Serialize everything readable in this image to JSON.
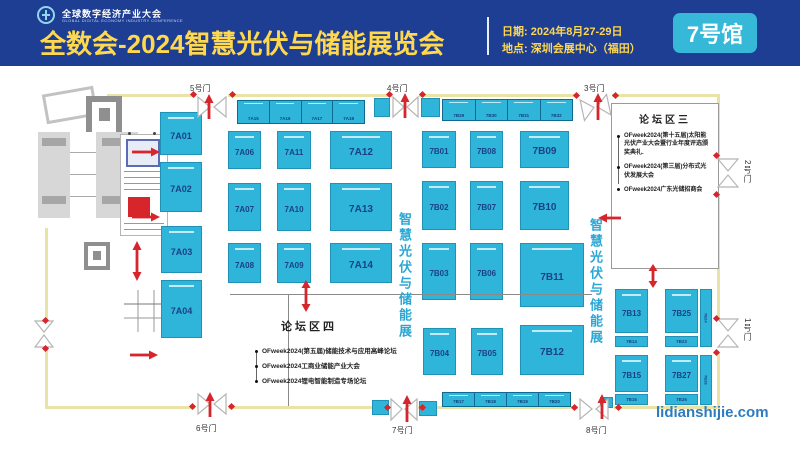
{
  "header": {
    "logo_title": "全球数字经济产业大会",
    "logo_subtitle": "GLOBAL DIGITAL ECONOMY INDUSTRY CONFERENCE",
    "title": "全数会-2024智慧光伏与储能展览会",
    "date": "日期: 2024年8月27-29日",
    "venue": "地点: 深圳会展中心（福田）",
    "hall": "7号馆"
  },
  "banner_vertical": "智慧光伏与储能展",
  "watermark": "lidianshijie.com",
  "doors": [
    "1号门",
    "2号门",
    "3号门",
    "4号门",
    "5号门",
    "6号门",
    "7号门",
    "8号门"
  ],
  "forum3": {
    "title": "论坛区三",
    "items": [
      "OFweek2024(第十五届)太阳能光伏产业大会暨行业年度评选颁奖典礼.",
      "OFweek2024(第三届)分布式光伏发展大会",
      "OFweek2024广东光储招商会"
    ]
  },
  "forum4": {
    "title": "论坛区四",
    "items": [
      "OFweek2024(第五届)储能技术与应用高峰论坛",
      "OFweek2024工商业储能产业大会",
      "OFweek2024锂电智能制造专场论坛"
    ]
  },
  "booths": [
    "7A01",
    "7A02",
    "7A03",
    "7A04",
    "7A06",
    "7A11",
    "7A12",
    "7A07",
    "7A10",
    "7A13",
    "7A08",
    "7A09",
    "7A14",
    "7B01",
    "7B08",
    "7B09",
    "7B02",
    "7B07",
    "7B10",
    "7B03",
    "7B06",
    "7B11",
    "7B04",
    "7B05",
    "7B12",
    "7B13",
    "7B14",
    "7B25",
    "7B24",
    "7B23",
    "7B15",
    "7B16",
    "7B27",
    "7B28",
    "7B26",
    "7A15",
    "7A16",
    "7A17",
    "7A18",
    "7B29",
    "7B30",
    "7B31",
    "7B32",
    "7B17",
    "7B18",
    "7B19",
    "7B20"
  ],
  "colors": {
    "header_bg": "#1d3e92",
    "accent_yellow": "#ffd84d",
    "badge_cyan": "#36b9d9",
    "booth_cyan": "#2fb5d9",
    "booth_text": "#1a4186",
    "wall_yellow": "#e9e3a6",
    "red": "#d6252b",
    "banner_blue": "#2aa7d4",
    "watermark_blue": "#2d7bc0"
  }
}
